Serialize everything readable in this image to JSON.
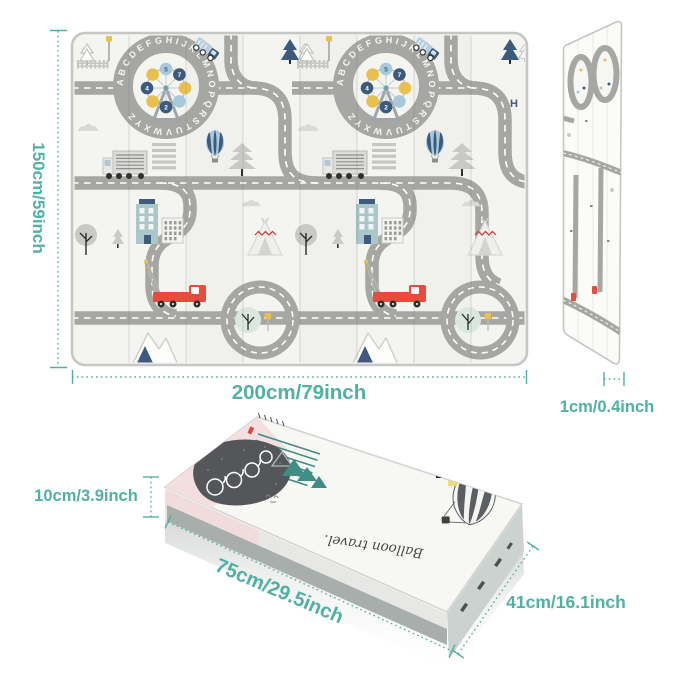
{
  "page": {
    "background": "#ffffff",
    "accent_color": "#4fb0a3"
  },
  "unfolded_mat": {
    "height_label": "150cm/59inch",
    "width_label": "200cm/79inch",
    "thickness_label": "1cm/0.4inch",
    "alphabet_ring": "ABCDEFGHIJKLMNOPQRSTUVWXYZ",
    "ferris_numbers": [
      "5",
      "7",
      "2",
      "4"
    ],
    "road_marking_letter": "H"
  },
  "folded_mat": {
    "height_label": "10cm/3.9inch",
    "length_label": "75cm/29.5inch",
    "width_label": "41cm/16.1inch",
    "print_text": "Balloon travel."
  },
  "colors": {
    "accent_teal_text": "#4fb0a3",
    "road_gray": "#a6a7a3",
    "navy": "#3c5a7c",
    "light_blue": "#a8c8dc",
    "yellow": "#e9c050",
    "red_truck": "#e84b3c",
    "pink_band": "#f3dfe0",
    "dark_blob": "#54565a",
    "teal_trees": "#3f8e85",
    "mat_surface": "#f4f4f1"
  }
}
